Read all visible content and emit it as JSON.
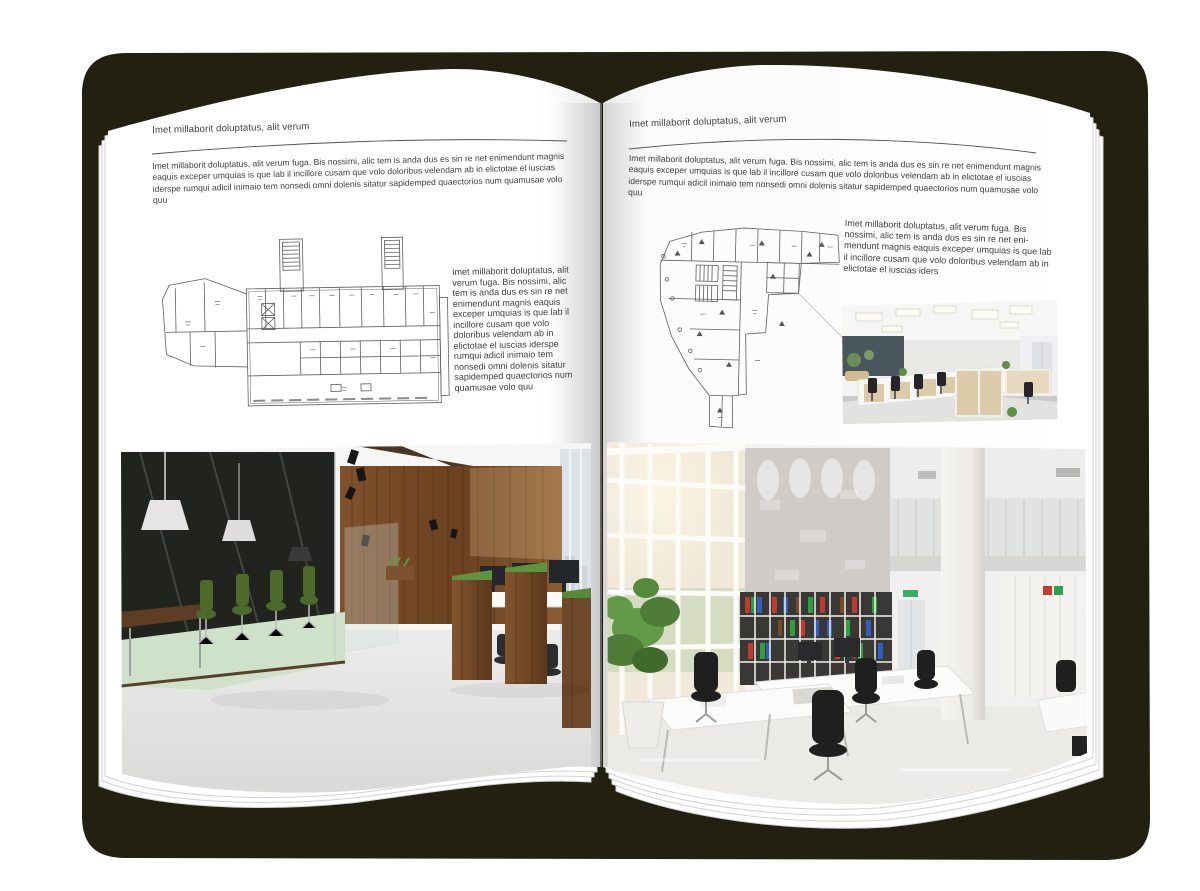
{
  "artwork": {
    "background_color": "#ffffff",
    "book_shadow_color": "#22210f",
    "paper_color": "#ffffff"
  },
  "left_page": {
    "header": "Imet millaborit doluptatus, alit verum",
    "intro": "Imet millaborit doluptatus, alit verum fuga. Bis nossimi, alic tem is anda dus es sin re net enimendunt magnis eaquis exceper umquias is que lab il incillore cusam que volo doloribus velendam ab in elictotae el iuscias iderspe rumqui adicil inimaio tem nonsedi omni dolenis sitatur sapidemped quaectorios num quamusae volo quu",
    "sidebar_text": "Imet millaborit doluptatus, alit verum fuga. Bis nossimi, alic tem is anda dus es sin re net enimendunt magnis eaquis exceper umquias is que lab il incillore cusam que volo doloribus velendam ab in elictotae el iuscias iderspe rumqui adicil inimaio tem nonsedi omni dolenis sitatur sapidemped quaectorios num quamusae volo quu",
    "floor_plan": "rectangular-building-floor-plan-with-stair-towers",
    "photo": "loft-office-interior-wood-wall-glass-meeting-room-green-chairs"
  },
  "right_page": {
    "header": "Imet millaborit doluptatus, alit verum",
    "intro": "Imet millaborit doluptatus, alit verum fuga. Bis nossimi, alic tem is anda dus es sin re net enimendunt magnis eaquis exceper umquias is que lab il incillore cusam que volo doloribus velendam ab in elictotae el iuscias iderspe rumqui adicil inimaio tem nonsedi omni dolenis sitatur sapidemped quaectorios num quamusae volo quu",
    "sidebar_text": "Imet millaborit doluptatus, alit verum fuga. Bis nossimi, alic tem is anda dus es sin re net eni-mendunt magnis eaquis exceper umquias is que lab il incillore cusam que volo doloribus velendam ab in elictotae el iuscias iders",
    "floor_plan": "irregular-building-floor-plan",
    "photo_small": "open-plan-office-cubicles-wood-cabinets",
    "photo_large": "bright-atrium-office-white-desks-binder-shelves"
  }
}
